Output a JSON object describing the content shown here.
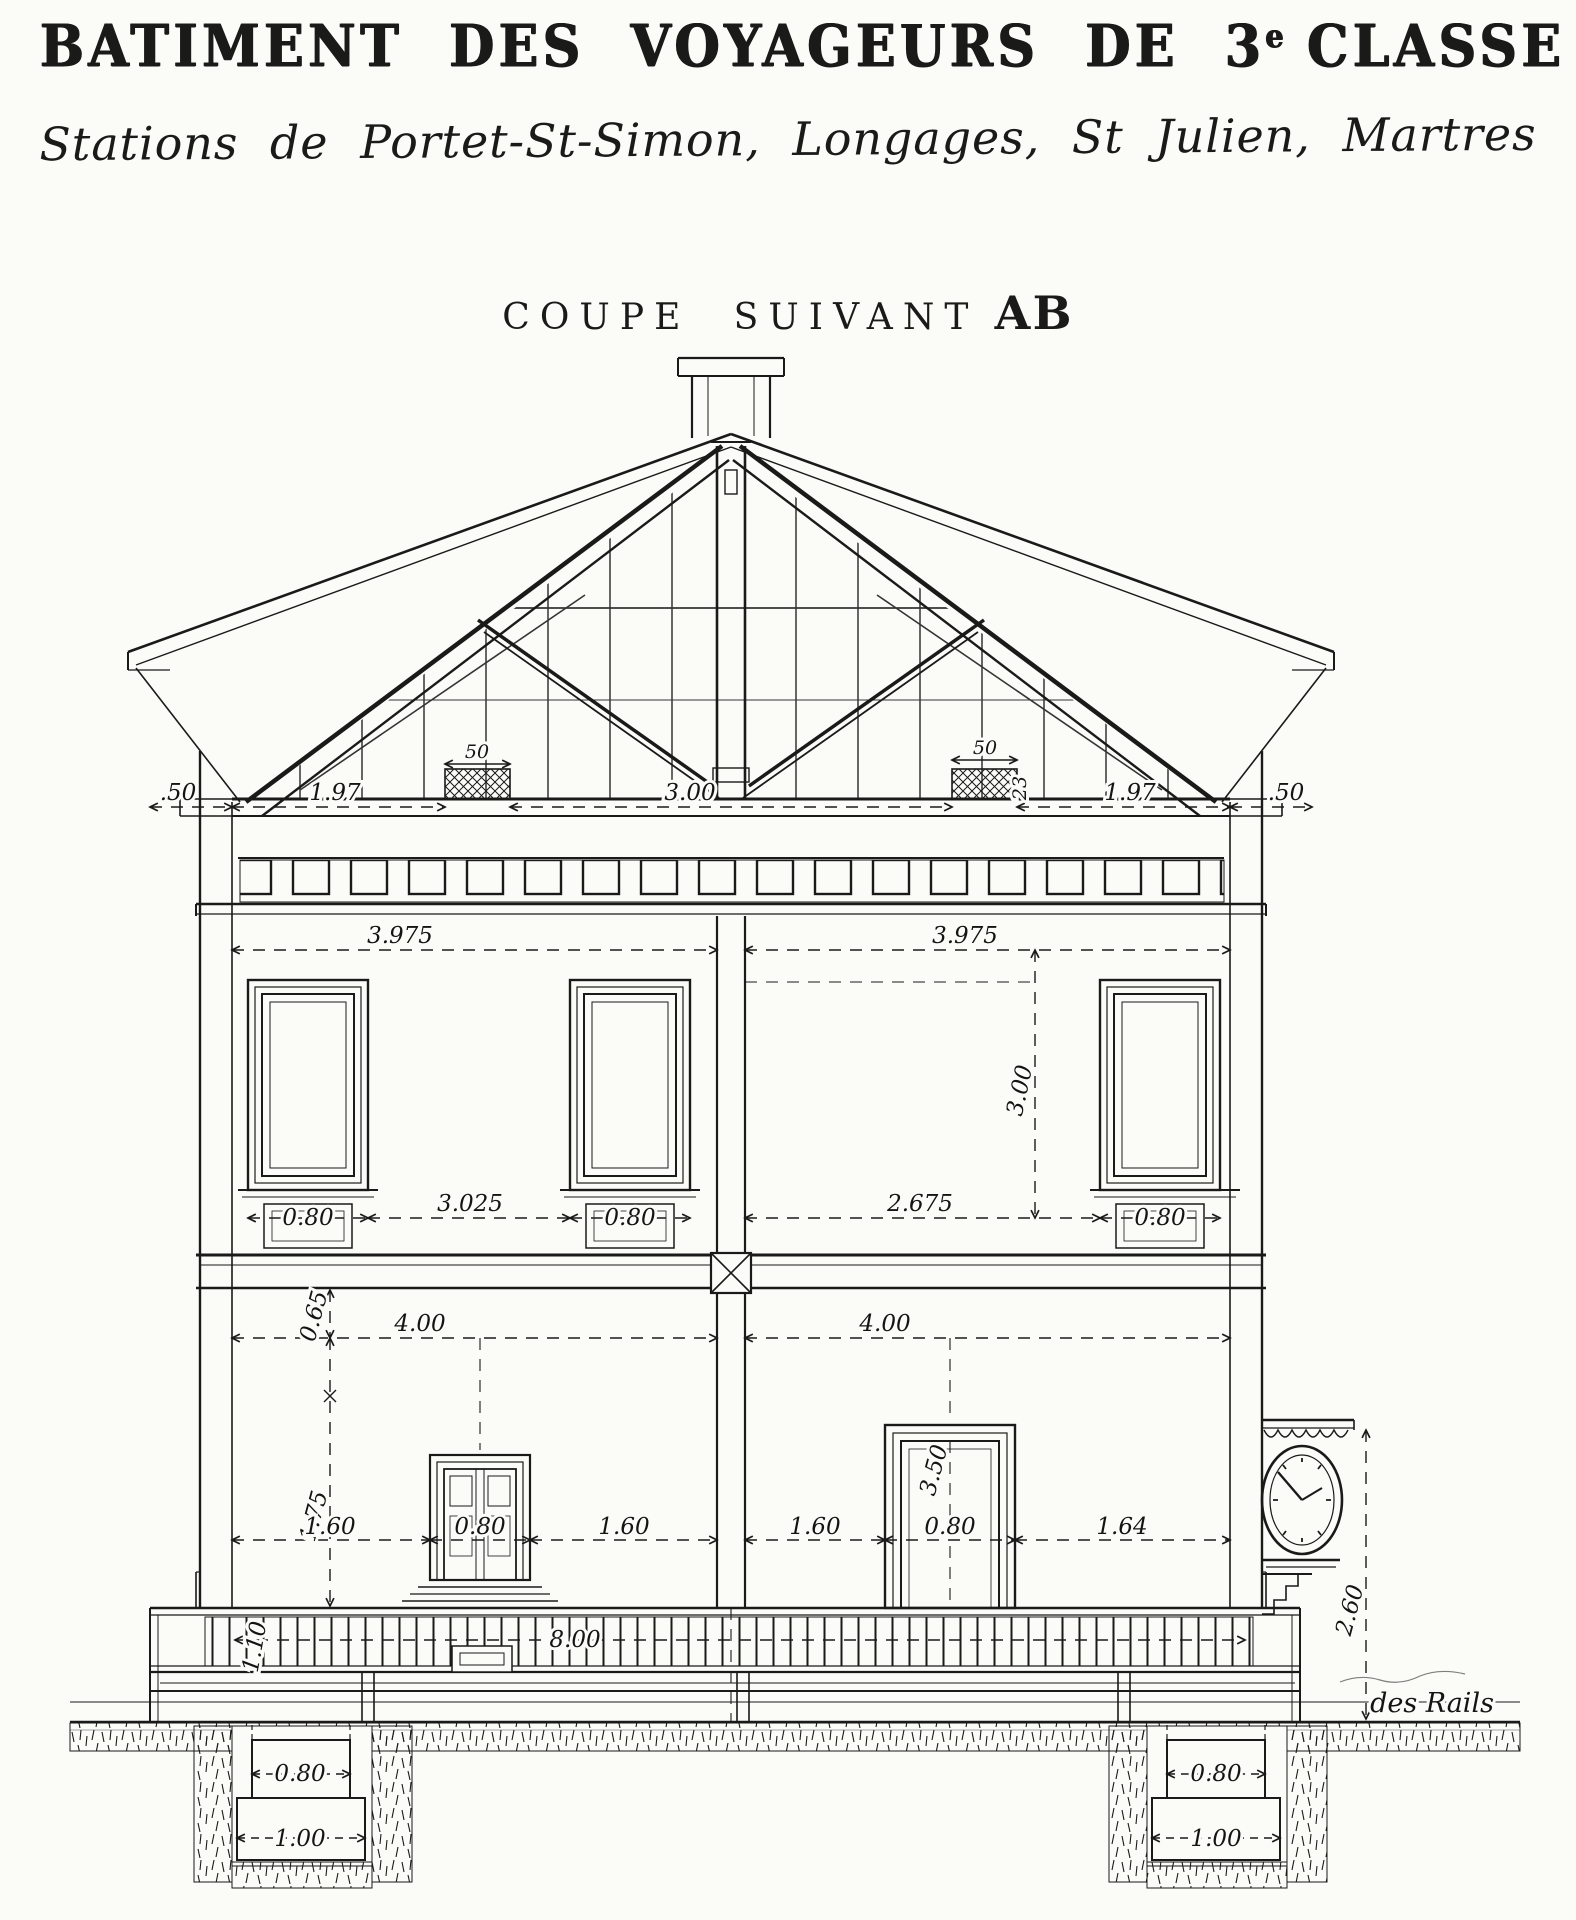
{
  "header": {
    "title_prefix": "BATIMENT DES VOYAGEURS DE 3",
    "title_sup": "e",
    "title_suffix": "CLASSE",
    "subtitle": "Stations de Portet-St-Simon, Longages, St Julien, Martres",
    "section_prefix": "COUPE SUIVANT",
    "section_ref": "AB"
  },
  "dims": {
    "attic_eave_left": ".50",
    "attic_span_left": "1.97",
    "attic_vent_left": "50",
    "attic_center": "3.00",
    "attic_vent_right": "50",
    "attic_vent_side": "23",
    "attic_span_right": "1.97",
    "attic_eave_right": ".50",
    "upper_room_left": "3.975",
    "upper_room_right": "3.975",
    "upper_window_height": "3.00",
    "sill_window_left": "0.80",
    "sill_span_left": "3.025",
    "sill_window_center": "0.80",
    "sill_span_right": "2.675",
    "sill_window_right": "0.80",
    "ground_room_left": "4.00",
    "ground_room_right": "4.00",
    "floor_drop": "0.65",
    "pier_height": "1.75",
    "door_height": "3.50",
    "door_left_span_a": "1.60",
    "door_left_width": "0.80",
    "door_left_span_b": "1.60",
    "door_right_span_a": "1.60",
    "door_right_width": "0.80",
    "door_right_span_b": "1.64",
    "platform_width": "8.00",
    "railing_height": "1.10",
    "foundation_left_width": "0.80",
    "foundation_left_base": "1.00",
    "foundation_right_width": "0.80",
    "foundation_right_base": "1.00",
    "clock_height": "2.60"
  },
  "annotations": {
    "rails": "des Rails"
  }
}
